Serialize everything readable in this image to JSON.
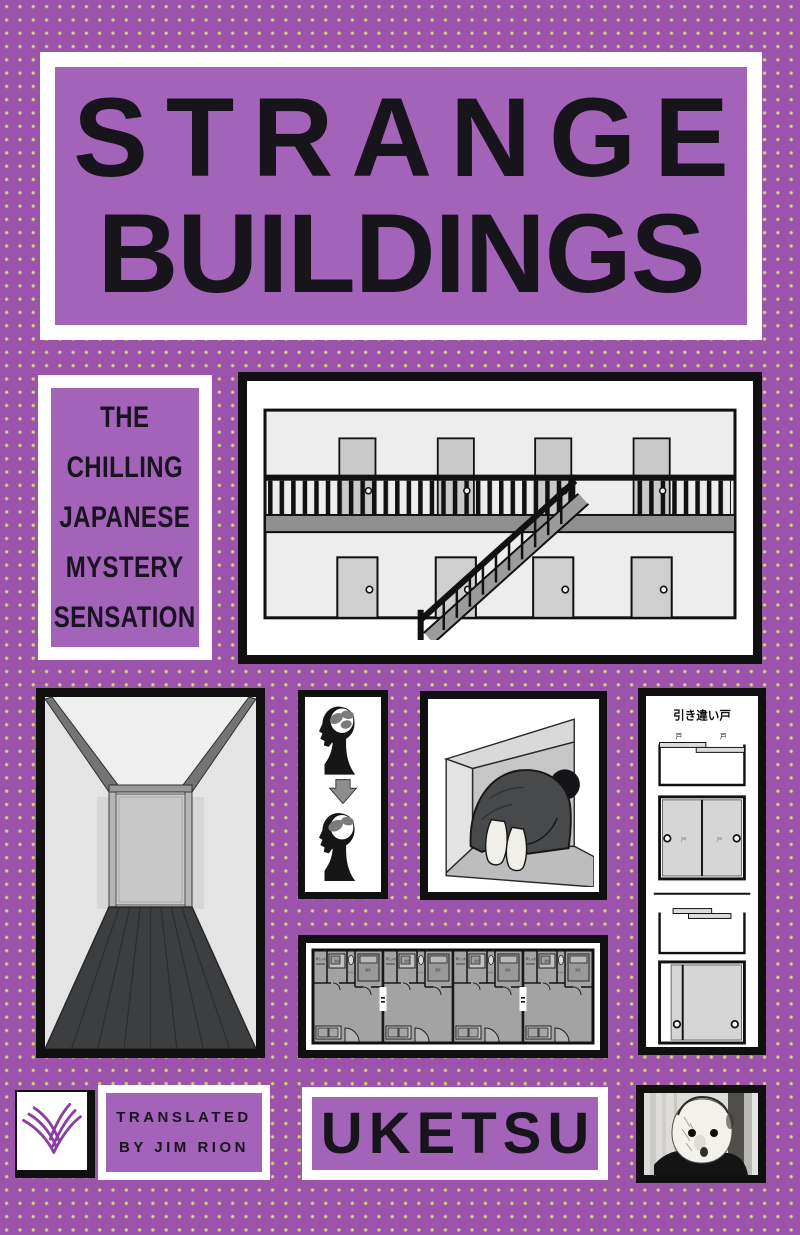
{
  "cover": {
    "title": {
      "line1": "STRANGE",
      "line2": "BUILDINGS"
    },
    "tagline": {
      "line1": "THE",
      "line2": "CHILLING",
      "line3": "JAPANESE",
      "line4": "MYSTERY",
      "line5": "SENSATION"
    },
    "author": "UKETSU",
    "translator": {
      "line1": "TRANSLATED",
      "line2": "BY JIM RION"
    }
  },
  "sliding_door_panel": {
    "title": "引き違い戸",
    "door_label": "戸"
  },
  "floor_plan_panel": {
    "labels": {
      "closet": "押し入れ",
      "bath": "浴室",
      "toilet": "トイレ",
      "bedroom": "寝室"
    }
  },
  "icons": {
    "publisher_logo": "open-book-curves",
    "building_panel": "two-story-apartment-cross-section",
    "hallway_panel": "perspective-corridor",
    "heads_panel": "head-brain-before-after-diagram",
    "crouch_panel": "person-crouching-in-crawlspace",
    "floor_plan_panel": "four-unit-apartment-floor-plan",
    "face_panel": "masked-face-photo"
  },
  "colors": {
    "background_purple": "#9b53ac",
    "panel_purple": "#a263b8",
    "dot_yellow_green": "#b7b170",
    "frame_white": "#ffffff",
    "ink_black": "#101010",
    "logo_purple": "#8a3fa5"
  }
}
